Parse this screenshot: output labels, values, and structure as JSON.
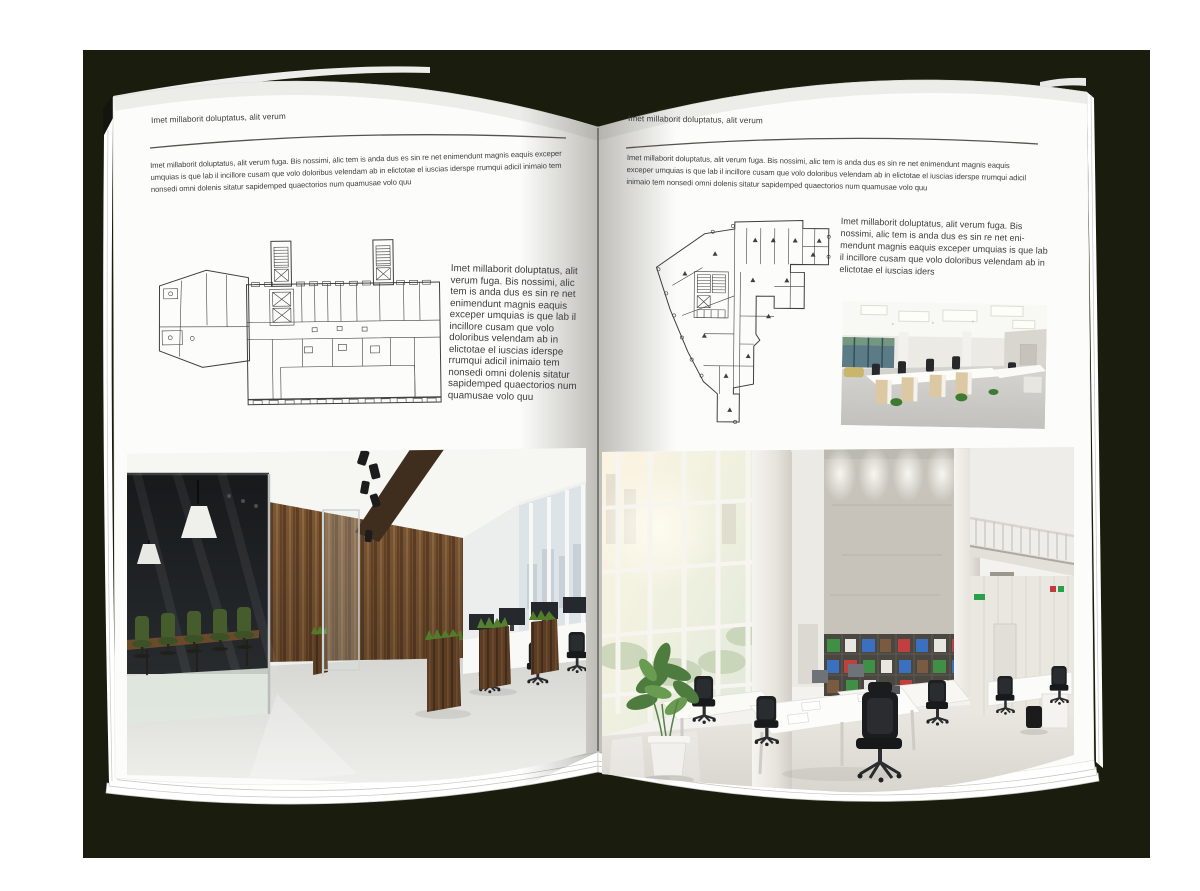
{
  "colors": {
    "backdrop": "#1a1c0d",
    "paper": "#fcfcfa",
    "body_text": "#3f3f3f",
    "rule_line": "#55534e",
    "wood_accent": "#7b5634",
    "plant_green": "#4e7c3f"
  },
  "left_page": {
    "header": "Imet millaborit doluptatus, alit verum",
    "intro": "Imet millaborit doluptatus, alit verum fuga. Bis nossimi, alic tem is anda dus es sin re net enimendunt magnis eaquis exceper umquias is que lab il incillore cusam que volo doloribus velendam ab in elictotae el iuscias iderspe rrumqui adicil inimaio tem nonsedi omni dolenis sitatur sapidemped quaectorios num quamusae volo quu",
    "side_paragraph": "Imet millaborit doluptatus, alit verum fuga. Bis nossimi, alic tem is anda dus es sin re net enimendunt magnis eaquis exceper umquias is que lab il incillore cusam que volo doloribus velendam ab in elictotae el iuscias iderspe rrumqui adicil inimaio tem nonsedi omni dolenis sitatur sapidemped quaectorios num quamusae volo quu"
  },
  "right_page": {
    "header": "Imet millaborit doluptatus, alit verum",
    "intro": "Imet millaborit doluptatus, alit verum fuga. Bis nossimi, alic tem is anda dus es sin re net enimendunt magnis eaquis exceper umquias is que lab il incillore cusam que volo doloribus velendam ab in elictotae el iuscias iderspe rrumqui adicil inimaio tem nonsedi omni dolenis sitatur sapidemped quaectorios num quamusae volo quu",
    "side_paragraph": "Imet millaborit doluptatus, alit verum fuga. Bis nossimi, alic tem is anda dus es sin re net eni-mendunt magnis eaquis exceper umquias is que lab il incillore cusam que volo doloribus velendam ab in elictotae el iuscias iders"
  }
}
